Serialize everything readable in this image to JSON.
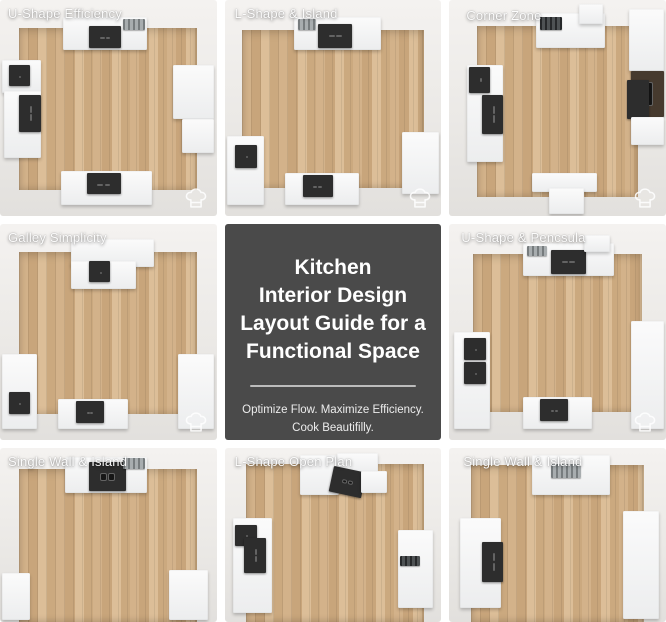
{
  "poster": {
    "type": "kitchen-layout-guide-infographic",
    "grid": "3x3",
    "background": "#ffffff"
  },
  "center_card": {
    "title_lines": [
      "Kitchen",
      "Interior Design",
      "Layout Guide for a",
      "Functional Space"
    ],
    "subtitle_lines": [
      "Optimize Flow. Maximize Efficiency.",
      "Cook Beautifilly."
    ],
    "background": "#4a4a4a",
    "text_color": "#ffffff",
    "divider_color": "#bcbcbc"
  },
  "tiles": [
    {
      "label": "U-Shape Efficiency",
      "icon": "chef-hat-icon"
    },
    {
      "label": "L-Shape & Island",
      "icon": "chef-hat-icon"
    },
    {
      "label": "Corner Zone",
      "icon": "chef-hat-icon"
    },
    {
      "label": "Galley Simplicity",
      "icon": "chef-hat-icon"
    },
    {
      "label": "U-Shape & Pencsula",
      "icon": "chef-hat-icon"
    },
    {
      "label": "Single Wall & Island"
    },
    {
      "label": "L-Shape Open Plan"
    },
    {
      "label": "Single Wall & Island"
    }
  ],
  "colors": {
    "wall": "#ece9e6",
    "floor_wood": "#cdab81",
    "cabinet": "#f5f5f5",
    "appliance": "#2d2d2d",
    "label_text": "#ffffff"
  }
}
